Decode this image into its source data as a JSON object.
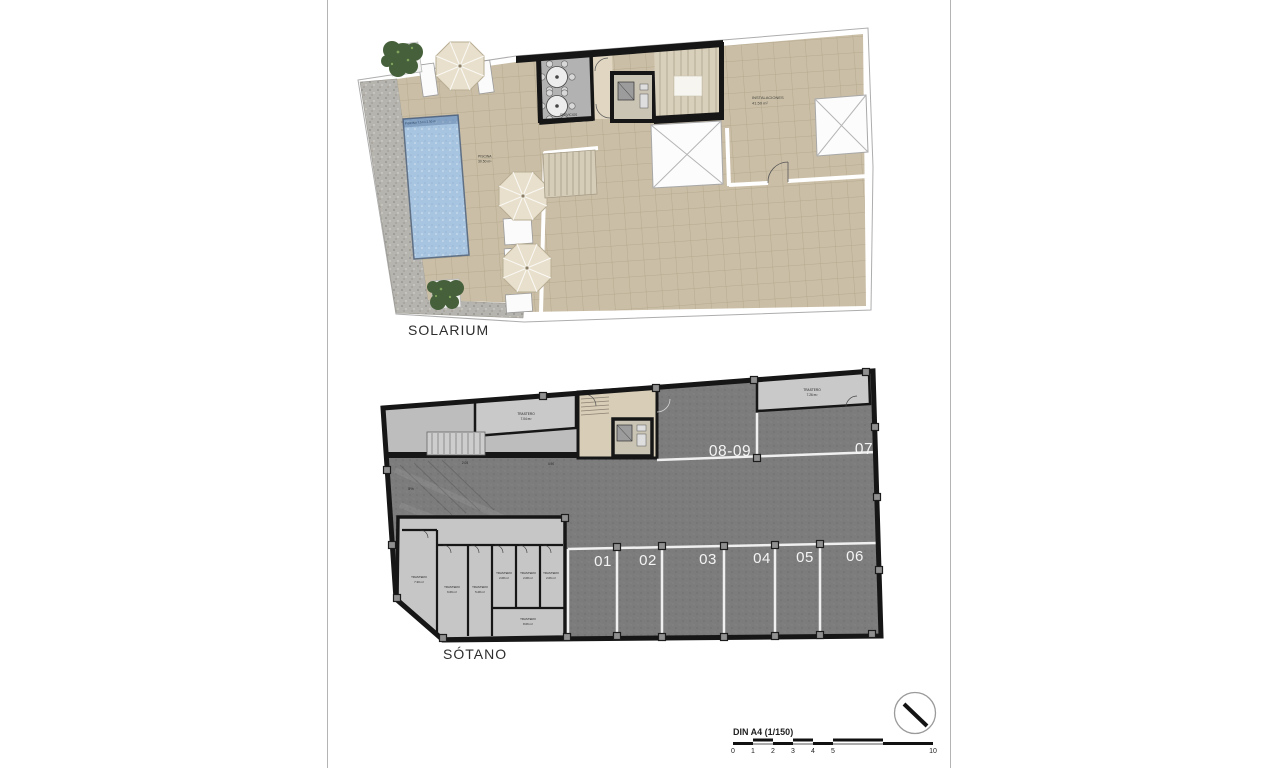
{
  "solarium": {
    "title": "SOLARIUM",
    "pool_strip_label": "PISCINA 7.50 x 2.50 m",
    "pool_label": {
      "line1": "PISCINA",
      "line2": "30.50 m²"
    },
    "services_label": "SERVICIOS",
    "installations_label": {
      "line1": "INSTALACIONES",
      "line2": "41.50 m²"
    }
  },
  "sotano": {
    "title": "SÓTANO",
    "parking_bottom": [
      "01",
      "02",
      "03",
      "04",
      "05",
      "06"
    ],
    "parking_top": [
      "08-09",
      "07"
    ],
    "ramp_label": "5%",
    "dim_labels": [
      "2.05",
      "4.90"
    ],
    "trastero_word": "TRASTERO",
    "trasteros": {
      "top_left": "7.04 m²",
      "top_right": "7.26 m²",
      "left_tall": "7.30 m²",
      "tall_2": "6.69 m²",
      "tall_3": "5.28 m²",
      "small_1": "2.08 m²",
      "small_2": "2.08 m²",
      "small_3": "2.06 m²",
      "bottom_wide": "8.06 m²"
    }
  },
  "footer": {
    "scale_label": "DIN A4 (1/150)",
    "ticks": [
      "0",
      "1",
      "2",
      "3",
      "4",
      "5",
      "10"
    ]
  },
  "colors": {
    "floor_tan": "#cabea6",
    "pool_blue": "#a7c4e0",
    "wall_black": "#161616",
    "parking_dark": "#7c7c7c",
    "room_light": "#c6c6c6",
    "gravel": "#b6b4ae",
    "umbrella": "#e8e0cc",
    "plant_green": "#45603a",
    "marking_white": "#f2f2f2"
  }
}
